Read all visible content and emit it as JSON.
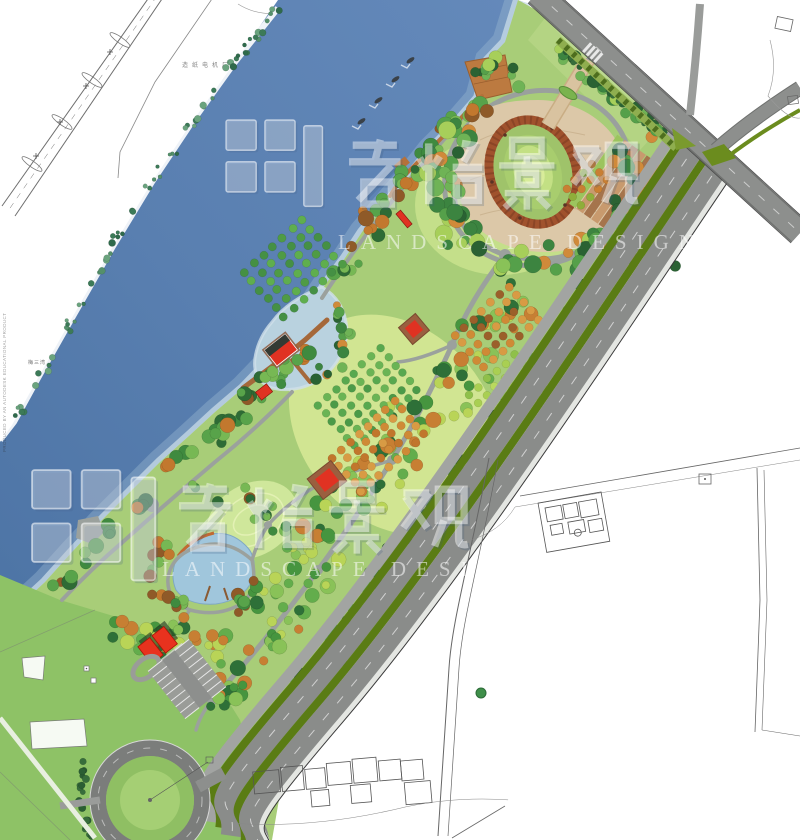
{
  "watermark": {
    "cn": "君怡景观",
    "en": "LANDSCAPE DESIGN"
  },
  "labels": {
    "factory": "造纸电机厂",
    "village": "梅三湾",
    "cad_stamp": "PRODUCED BY AN AUTODESK EDUCATIONAL PRODUCT"
  },
  "palette": {
    "river_deep": "#4d74a5",
    "river_mid": "#6489ba",
    "shore_light": "#9cb8d2",
    "shallow": "#c9dce8",
    "cove": "#b9d2df",
    "pond": "#a0c6dc",
    "park_base": "#a8cd78",
    "lawn_bright": "#c6e18c",
    "lawn_yellow": "#d3e694",
    "lawn_flat": "#8ec266",
    "road": "#8a8c8a",
    "road_top": "#8d8f8d",
    "median": "#5a7c14",
    "hedge": "#8fae4f",
    "path": "#9ba19d",
    "plaza": "#dcc8a8",
    "terrace_tan": "#c89a6e",
    "terrace_brown": "#a5744c",
    "ring": "#a0522d",
    "oval_lawn": "#a8cd6e",
    "deck": "#bc7a40",
    "roof": "#e03222",
    "cad": "#555555",
    "white_walk": "#e4e6e2"
  },
  "features": [
    "river",
    "boats",
    "waterfront-deck",
    "oval-amphitheater-plaza",
    "north-entrance-walk",
    "east-entrance-terraces",
    "orchard-grids",
    "cove-boardwalk-pavilions",
    "lakeside-pond",
    "service-buildings",
    "parking-lot",
    "tree-lined-roundabout",
    "main-boulevard",
    "cad-context-linework",
    "watermark-logo"
  ]
}
